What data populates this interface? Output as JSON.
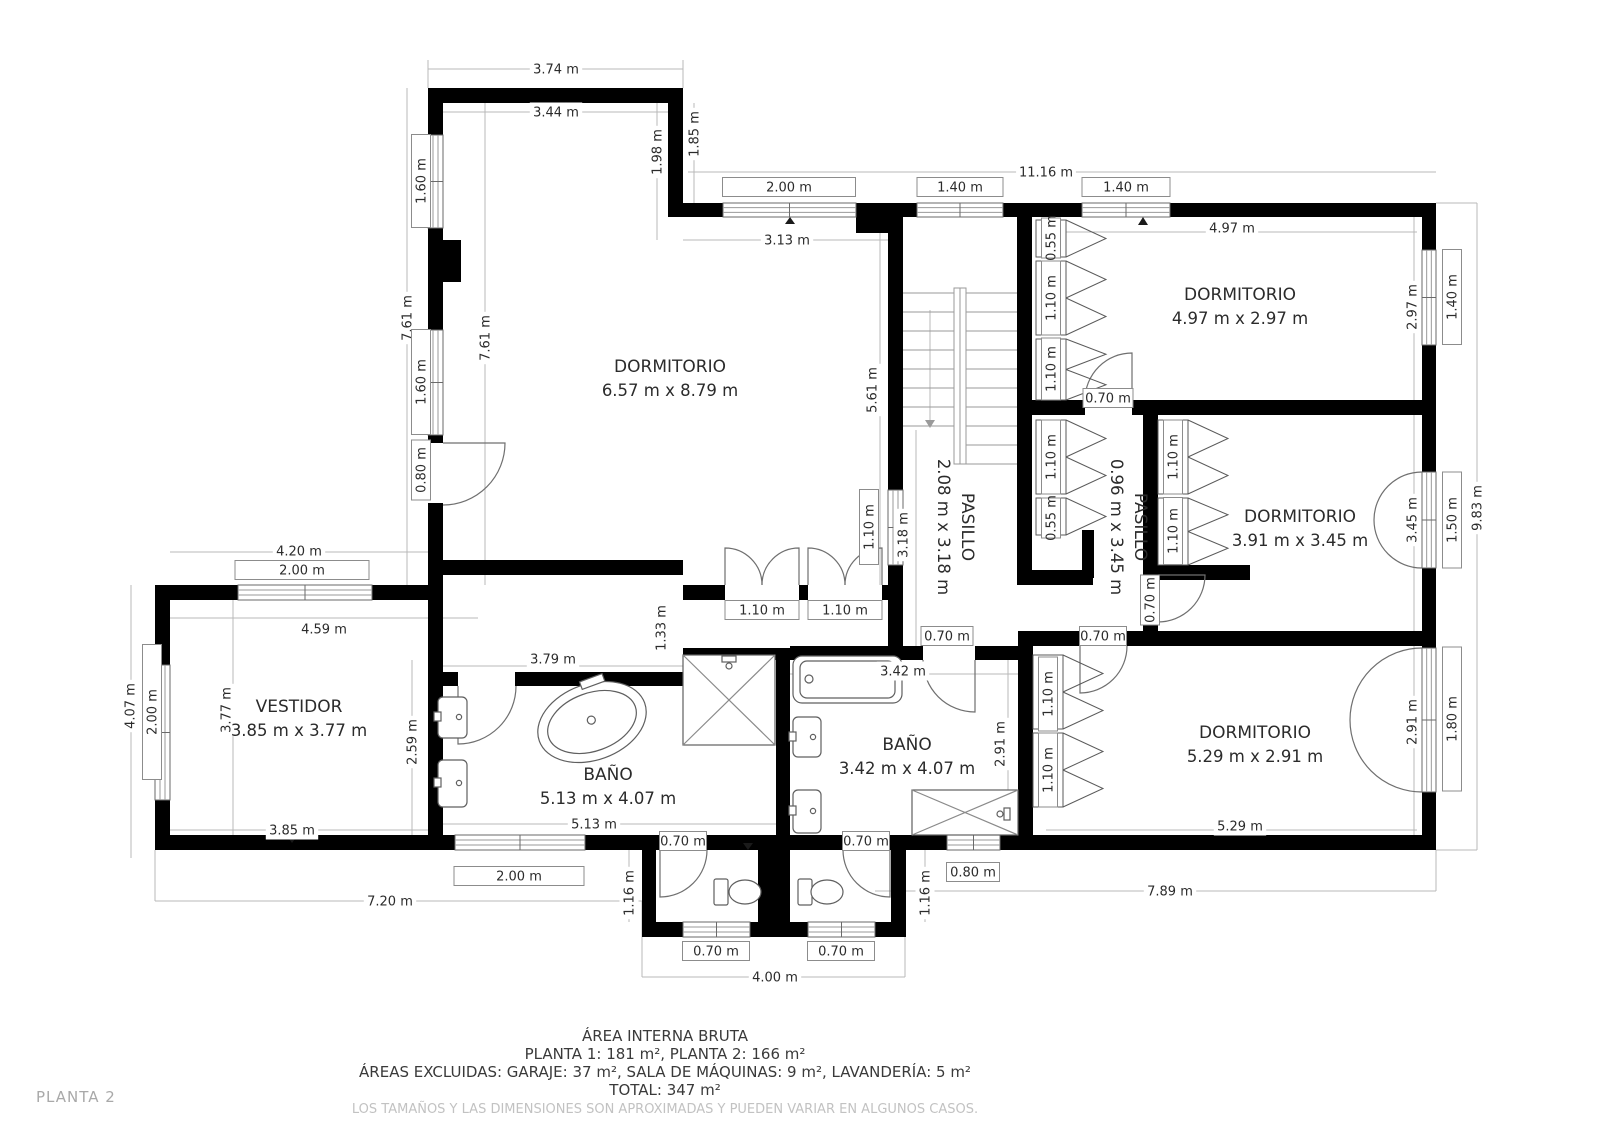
{
  "plan_label": "PLANTA 2",
  "footer": {
    "line1": "ÁREA INTERNA BRUTA",
    "line2": "PLANTA 1: 181 m², PLANTA 2: 166 m²",
    "line3": "ÁREAS EXCLUIDAS: GARAJE: 37 m², SALA DE MÁQUINAS: 9 m², LAVANDERÍA: 5 m²",
    "line4": "TOTAL: 347 m²",
    "disclaimer": "LOS TAMAÑOS Y LAS DIMENSIONES SON APROXIMADAS Y PUEDEN VARIAR EN ALGUNOS CASOS."
  },
  "rooms": [
    {
      "name": "DORMITORIO",
      "dims": "6.57 m x 8.79 m",
      "x": 670,
      "y": 372
    },
    {
      "name": "DORMITORIO",
      "dims": "4.97 m x 2.97 m",
      "x": 1240,
      "y": 300
    },
    {
      "name": "DORMITORIO",
      "dims": "3.91 m x 3.45 m",
      "x": 1300,
      "y": 522
    },
    {
      "name": "DORMITORIO",
      "dims": "5.29 m x 2.91 m",
      "x": 1255,
      "y": 738
    },
    {
      "name": "PASILLO",
      "dims": "2.08 m x 3.18 m",
      "x": 962,
      "y": 527,
      "rot": 90
    },
    {
      "name": "PASILLO",
      "dims": "0.96 m x 3.45 m",
      "x": 1135,
      "y": 527,
      "rot": 90
    },
    {
      "name": "VESTIDOR",
      "dims": "3.85 m x 3.77 m",
      "x": 299,
      "y": 712
    },
    {
      "name": "BAÑO",
      "dims": "5.13 m x 4.07 m",
      "x": 608,
      "y": 780
    },
    {
      "name": "BAÑO",
      "dims": "3.42 m x 4.07 m",
      "x": 907,
      "y": 750
    }
  ],
  "labels": [
    {
      "t": "3.74 m",
      "x": 556,
      "y": 69
    },
    {
      "t": "3.44 m",
      "x": 556,
      "y": 112
    },
    {
      "t": "1.85 m",
      "x": 694,
      "y": 134,
      "r": -90
    },
    {
      "t": "1.98 m",
      "x": 657,
      "y": 152,
      "r": -90
    },
    {
      "t": "1.60 m",
      "x": 421,
      "y": 181,
      "r": -90,
      "bw": 93
    },
    {
      "t": "7.61 m",
      "x": 407,
      "y": 318,
      "r": -90
    },
    {
      "t": "7.61 m",
      "x": 485,
      "y": 338,
      "r": -90
    },
    {
      "t": "1.60 m",
      "x": 421,
      "y": 382,
      "r": -90,
      "bw": 105
    },
    {
      "t": "0.80 m",
      "x": 421,
      "y": 470,
      "r": -90,
      "bw": 60
    },
    {
      "t": "2.00 m",
      "x": 789,
      "y": 187,
      "bw": 133
    },
    {
      "t": "1.40 m",
      "x": 960,
      "y": 187,
      "bw": 86
    },
    {
      "t": "1.40 m",
      "x": 1126,
      "y": 187,
      "bw": 88
    },
    {
      "t": "11.16 m",
      "x": 1046,
      "y": 172
    },
    {
      "t": "3.13 m",
      "x": 787,
      "y": 240
    },
    {
      "t": "4.97 m",
      "x": 1232,
      "y": 228
    },
    {
      "t": "2.97 m",
      "x": 1412,
      "y": 307,
      "r": -90
    },
    {
      "t": "1.40 m",
      "x": 1452,
      "y": 297,
      "r": -90,
      "bw": 95
    },
    {
      "t": "9.83 m",
      "x": 1477,
      "y": 508,
      "r": -90
    },
    {
      "t": "1.50 m",
      "x": 1452,
      "y": 520,
      "r": -90,
      "bw": 96
    },
    {
      "t": "3.45 m",
      "x": 1412,
      "y": 520,
      "r": -90
    },
    {
      "t": "1.80 m",
      "x": 1452,
      "y": 719,
      "r": -90,
      "bw": 144
    },
    {
      "t": "2.91 m",
      "x": 1412,
      "y": 722,
      "r": -90
    },
    {
      "t": "5.61 m",
      "x": 872,
      "y": 390,
      "r": -90
    },
    {
      "t": "0.55 m",
      "x": 1051,
      "y": 238,
      "r": -90,
      "bw": 40
    },
    {
      "t": "1.10 m",
      "x": 1051,
      "y": 298,
      "r": -90,
      "bw": 74
    },
    {
      "t": "1.10 m",
      "x": 1051,
      "y": 369,
      "r": -90,
      "bw": 62
    },
    {
      "t": "0.70 m",
      "x": 1108,
      "y": 398,
      "bw": 50
    },
    {
      "t": "1.10 m",
      "x": 1051,
      "y": 457,
      "r": -90,
      "bw": 74
    },
    {
      "t": "0.55 m",
      "x": 1051,
      "y": 518,
      "r": -90,
      "bw": 40
    },
    {
      "t": "1.10 m",
      "x": 1173,
      "y": 457,
      "r": -90,
      "bw": 74
    },
    {
      "t": "1.10 m",
      "x": 1173,
      "y": 531,
      "r": -90,
      "bw": 67
    },
    {
      "t": "0.70 m",
      "x": 1150,
      "y": 600,
      "r": -90,
      "bw": 50
    },
    {
      "t": "3.18 m",
      "x": 903,
      "y": 535,
      "r": -90
    },
    {
      "t": "1.10 m",
      "x": 869,
      "y": 527,
      "r": -90,
      "bw": 75
    },
    {
      "t": "1.33 m",
      "x": 661,
      "y": 628,
      "r": -90
    },
    {
      "t": "1.10 m",
      "x": 762,
      "y": 610,
      "bw": 74
    },
    {
      "t": "1.10 m",
      "x": 845,
      "y": 610,
      "bw": 74
    },
    {
      "t": "0.70 m",
      "x": 947,
      "y": 636,
      "bw": 52
    },
    {
      "t": "0.70 m",
      "x": 1103,
      "y": 636,
      "bw": 47
    },
    {
      "t": "1.10 m",
      "x": 1048,
      "y": 694,
      "r": -90,
      "bw": 74
    },
    {
      "t": "1.10 m",
      "x": 1048,
      "y": 770,
      "r": -90,
      "bw": 74
    },
    {
      "t": "2.91 m",
      "x": 1000,
      "y": 744,
      "r": -90
    },
    {
      "t": "0.70 m",
      "x": 683,
      "y": 841,
      "bw": 47
    },
    {
      "t": "0.70 m",
      "x": 866,
      "y": 841,
      "bw": 47
    },
    {
      "t": "0.80 m",
      "x": 973,
      "y": 872,
      "bw": 53
    },
    {
      "t": "3.42 m",
      "x": 903,
      "y": 671
    },
    {
      "t": "1.16 m",
      "x": 629,
      "y": 893,
      "r": -90
    },
    {
      "t": "1.16 m",
      "x": 925,
      "y": 893,
      "r": -90
    },
    {
      "t": "0.70 m",
      "x": 716,
      "y": 951,
      "bw": 67
    },
    {
      "t": "0.70 m",
      "x": 841,
      "y": 951,
      "bw": 67
    },
    {
      "t": "4.00 m",
      "x": 775,
      "y": 977
    },
    {
      "t": "5.13 m",
      "x": 594,
      "y": 824
    },
    {
      "t": "2.00 m",
      "x": 519,
      "y": 876,
      "bw": 130
    },
    {
      "t": "7.20 m",
      "x": 390,
      "y": 901
    },
    {
      "t": "3.85 m",
      "x": 292,
      "y": 830
    },
    {
      "t": "7.89 m",
      "x": 1170,
      "y": 891
    },
    {
      "t": "5.29 m",
      "x": 1240,
      "y": 826
    },
    {
      "t": "3.79 m",
      "x": 553,
      "y": 659
    },
    {
      "t": "4.20 m",
      "x": 299,
      "y": 551
    },
    {
      "t": "2.00 m",
      "x": 302,
      "y": 570,
      "bw": 134
    },
    {
      "t": "4.59 m",
      "x": 324,
      "y": 629
    },
    {
      "t": "3.77 m",
      "x": 226,
      "y": 710,
      "r": -90
    },
    {
      "t": "4.07 m",
      "x": 130,
      "y": 706,
      "r": -90
    },
    {
      "t": "2.00 m",
      "x": 152,
      "y": 712,
      "r": -90,
      "bw": 135
    },
    {
      "t": "2.59 m",
      "x": 412,
      "y": 742,
      "r": -90
    }
  ],
  "colors": {
    "wall": "#000000",
    "dim_line": "#b9b9b9",
    "label_box_border": "#8c8c8c",
    "text": "#2b2b2b",
    "muted_text": "#a9a9a9",
    "disclaimer_text": "#c2c2c2"
  }
}
